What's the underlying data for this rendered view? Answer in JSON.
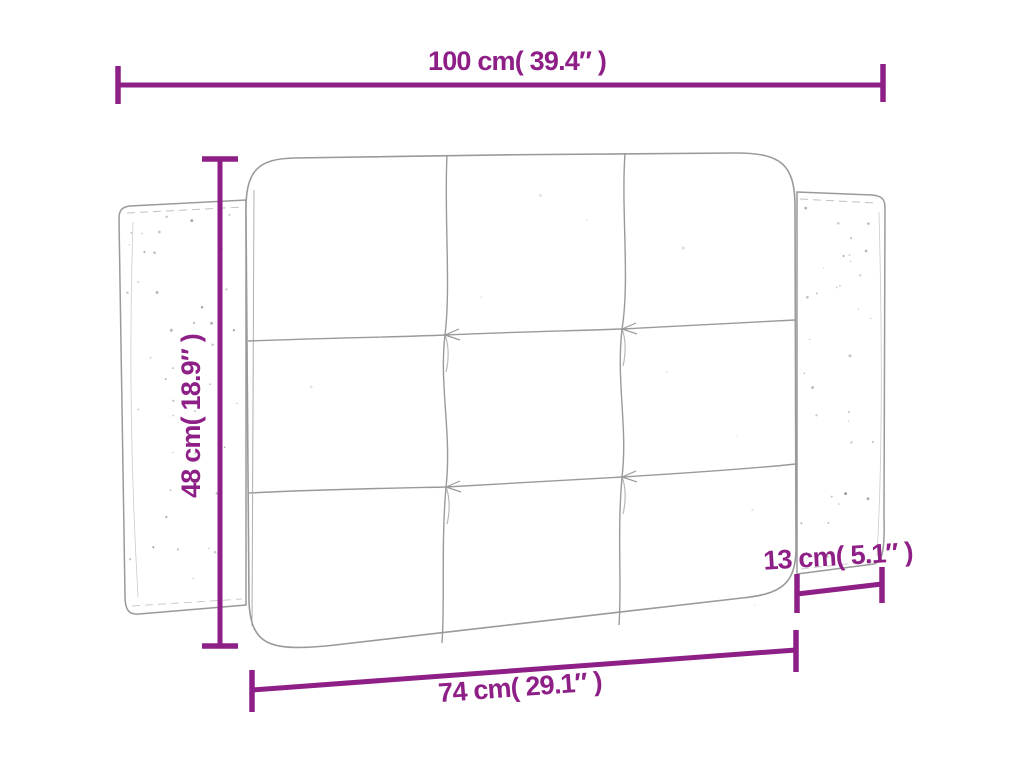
{
  "canvas": {
    "width": 1024,
    "height": 768,
    "background": "#ffffff"
  },
  "style": {
    "dimension_color": "#8e1f87",
    "outline_color": "#9a9a9a",
    "speckle_color": "#8a8a8a"
  },
  "diagram": {
    "figure": "tufted headboard cushion with two side wing panels, 3x3 panel grid, technical dimension drawing",
    "dimensions": {
      "overall_width": {
        "cm": 100,
        "in": 39.4,
        "label": "100 cm( 39.4″ )"
      },
      "height": {
        "cm": 48,
        "in": 18.9,
        "label": "48 cm( 18.9″ )"
      },
      "cushion_width": {
        "cm": 74,
        "in": 29.1,
        "label": "74 cm( 29.1″ )"
      },
      "wing_width": {
        "cm": 13,
        "in": 5.1,
        "label": "13 cm( 5.1″ )"
      }
    }
  }
}
